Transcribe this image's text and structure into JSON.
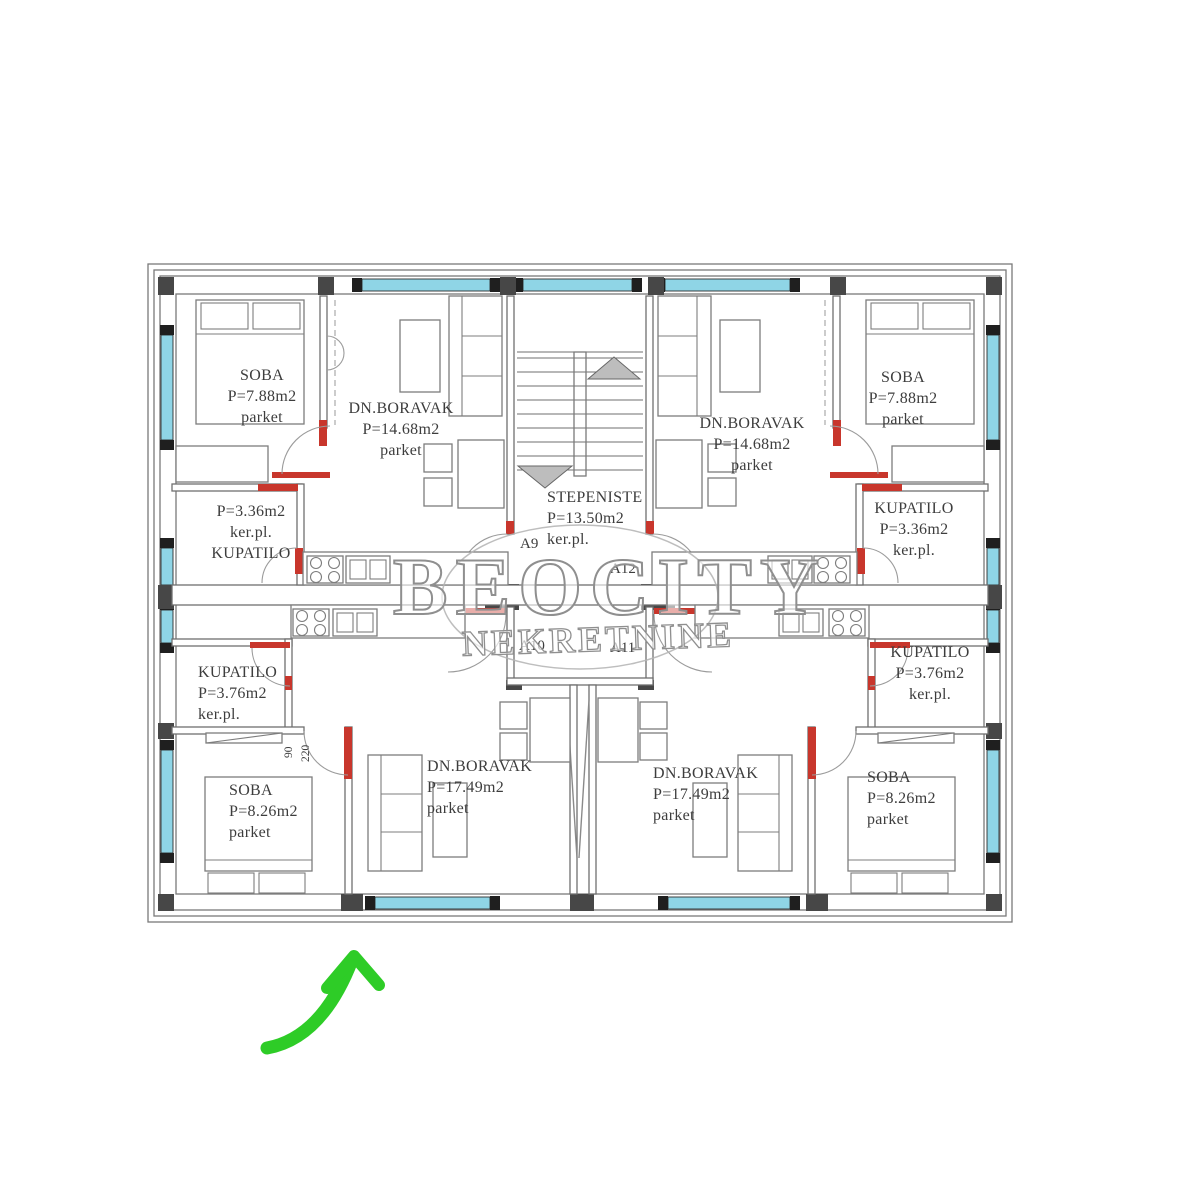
{
  "watermark": {
    "title": "BEOCITY",
    "subtitle": "NEKRETNINE"
  },
  "stairwell": {
    "name": "STEPENISTE",
    "area": "P=13.50m2",
    "floor": "ker.pl."
  },
  "units": {
    "a9": "A9",
    "a10": "A10",
    "a11": "A11",
    "a12": "A12"
  },
  "rooms": {
    "soba_tl": {
      "name": "SOBA",
      "area": "P=7.88m2",
      "floor": "parket"
    },
    "boravak_tl": {
      "name": "DN.BORAVAK",
      "area": "P=14.68m2",
      "floor": "parket"
    },
    "kupatilo_tl": {
      "name": "KUPATILO",
      "area": "P=3.36m2",
      "floor": "ker.pl."
    },
    "soba_tr": {
      "name": "SOBA",
      "area": "P=7.88m2",
      "floor": "parket"
    },
    "boravak_tr": {
      "name": "DN.BORAVAK",
      "area": "P=14.68m2",
      "floor": "parket"
    },
    "kupatilo_tr": {
      "name": "KUPATILO",
      "area": "P=3.36m2",
      "floor": "ker.pl."
    },
    "kupatilo_bl": {
      "name": "KUPATILO",
      "area": "P=3.76m2",
      "floor": "ker.pl."
    },
    "soba_bl": {
      "name": "SOBA",
      "area": "P=8.26m2",
      "floor": "parket"
    },
    "boravak_bl": {
      "name": "DN.BORAVAK",
      "area": "P=17.49m2",
      "floor": "parket"
    },
    "kupatilo_br": {
      "name": "KUPATILO",
      "area": "P=3.76m2",
      "floor": "ker.pl."
    },
    "soba_br": {
      "name": "SOBA",
      "area": "P=8.26m2",
      "floor": "parket"
    },
    "boravak_br": {
      "name": "DN.BORAVAK",
      "area": "P=17.49m2",
      "floor": "parket"
    }
  },
  "door_dimensions": {
    "width": "90",
    "height": "220"
  },
  "colors": {
    "window": "#8fd5e6",
    "door_marker": "#c8362c",
    "direction_arrow": "#2ecc27",
    "watermark_gray": "#8f8f8f",
    "wall_dark": "#474747"
  }
}
